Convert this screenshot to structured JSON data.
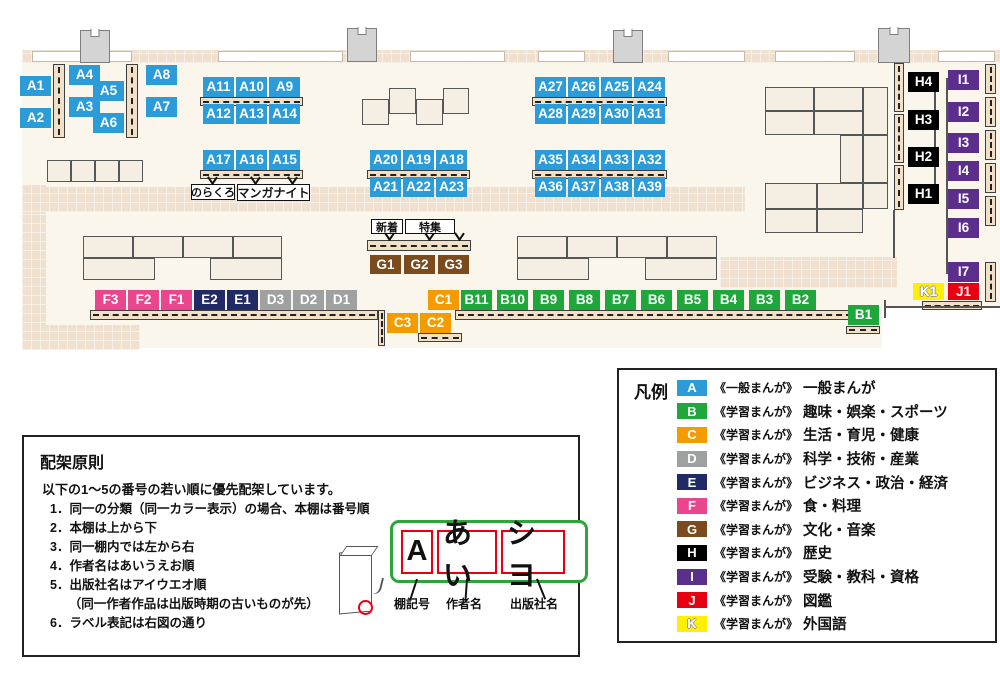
{
  "map": {
    "callouts": {
      "noracro": "のらくろ",
      "manga_night": "マンガナイト",
      "new_arrivals": "新着",
      "feature": "特集"
    },
    "shelf_labels": [
      {
        "id": "A1"
      },
      {
        "id": "A2"
      },
      {
        "id": "A3"
      },
      {
        "id": "A4"
      },
      {
        "id": "A5"
      },
      {
        "id": "A6"
      },
      {
        "id": "A7"
      },
      {
        "id": "A8"
      },
      {
        "id": "A9"
      },
      {
        "id": "A10"
      },
      {
        "id": "A11"
      },
      {
        "id": "A12"
      },
      {
        "id": "A13"
      },
      {
        "id": "A14"
      },
      {
        "id": "A15"
      },
      {
        "id": "A16"
      },
      {
        "id": "A17"
      },
      {
        "id": "A18"
      },
      {
        "id": "A19"
      },
      {
        "id": "A20"
      },
      {
        "id": "A21"
      },
      {
        "id": "A22"
      },
      {
        "id": "A23"
      },
      {
        "id": "A24"
      },
      {
        "id": "A25"
      },
      {
        "id": "A26"
      },
      {
        "id": "A27"
      },
      {
        "id": "A28"
      },
      {
        "id": "A29"
      },
      {
        "id": "A30"
      },
      {
        "id": "A31"
      },
      {
        "id": "A32"
      },
      {
        "id": "A33"
      },
      {
        "id": "A34"
      },
      {
        "id": "A35"
      },
      {
        "id": "A36"
      },
      {
        "id": "A37"
      },
      {
        "id": "A38"
      },
      {
        "id": "A39"
      },
      {
        "id": "B1"
      },
      {
        "id": "B2"
      },
      {
        "id": "B3"
      },
      {
        "id": "B4"
      },
      {
        "id": "B5"
      },
      {
        "id": "B6"
      },
      {
        "id": "B7"
      },
      {
        "id": "B8"
      },
      {
        "id": "B9"
      },
      {
        "id": "B10"
      },
      {
        "id": "B11"
      },
      {
        "id": "C1"
      },
      {
        "id": "C2"
      },
      {
        "id": "C3"
      },
      {
        "id": "D1"
      },
      {
        "id": "D2"
      },
      {
        "id": "D3"
      },
      {
        "id": "E1"
      },
      {
        "id": "E2"
      },
      {
        "id": "F1"
      },
      {
        "id": "F2"
      },
      {
        "id": "F3"
      },
      {
        "id": "G1"
      },
      {
        "id": "G2"
      },
      {
        "id": "G3"
      },
      {
        "id": "H1"
      },
      {
        "id": "H2"
      },
      {
        "id": "H3"
      },
      {
        "id": "H4"
      },
      {
        "id": "I1"
      },
      {
        "id": "I2"
      },
      {
        "id": "I3"
      },
      {
        "id": "I4"
      },
      {
        "id": "I5"
      },
      {
        "id": "I6"
      },
      {
        "id": "I7"
      },
      {
        "id": "J1"
      },
      {
        "id": "K1"
      }
    ]
  },
  "legend": {
    "title": "凡例",
    "rows": [
      {
        "letter": "A",
        "type": "《一般まんが》",
        "category": "一般まんが",
        "color": "#2B9CD8"
      },
      {
        "letter": "B",
        "type": "《学習まんが》",
        "category": "趣味・娯楽・スポーツ",
        "color": "#1FA73C"
      },
      {
        "letter": "C",
        "type": "《学習まんが》",
        "category": "生活・育児・健康",
        "color": "#F49B00"
      },
      {
        "letter": "D",
        "type": "《学習まんが》",
        "category": "科学・技術・産業",
        "color": "#9FA0A0"
      },
      {
        "letter": "E",
        "type": "《学習まんが》",
        "category": "ビジネス・政治・経済",
        "color": "#202A64"
      },
      {
        "letter": "F",
        "type": "《学習まんが》",
        "category": "食・料理",
        "color": "#E9468D"
      },
      {
        "letter": "G",
        "type": "《学習まんが》",
        "category": "文化・音楽",
        "color": "#7B4B1E"
      },
      {
        "letter": "H",
        "type": "《学習まんが》",
        "category": "歴史",
        "color": "#000000"
      },
      {
        "letter": "I",
        "type": "《学習まんが》",
        "category": "受験・教科・資格",
        "color": "#5C2E8C"
      },
      {
        "letter": "J",
        "type": "《学習まんが》",
        "category": "図鑑",
        "color": "#E60012"
      },
      {
        "letter": "K",
        "type": "《学習まんが》",
        "category": "外国語",
        "color": "#FFF000"
      }
    ]
  },
  "principles": {
    "title": "配架原則",
    "intro": "以下の1～5の番号の若い順に優先配架しています。",
    "rules": [
      "1．同一の分類（同一カラー表示）の場合、本棚は番号順",
      "2．本棚は上から下",
      "3．同一棚内では左から右",
      "4．作者名はあいうえお順",
      "5．出版社名はアイウエオ順",
      "　　（同一作者作品は出版時期の古いものが先）",
      "6．ラベル表記は右図の通り"
    ],
    "label_example": {
      "parts": [
        "A",
        "あい",
        "シヨ"
      ],
      "captions": [
        "棚記号",
        "作者名",
        "出版社名"
      ]
    }
  }
}
